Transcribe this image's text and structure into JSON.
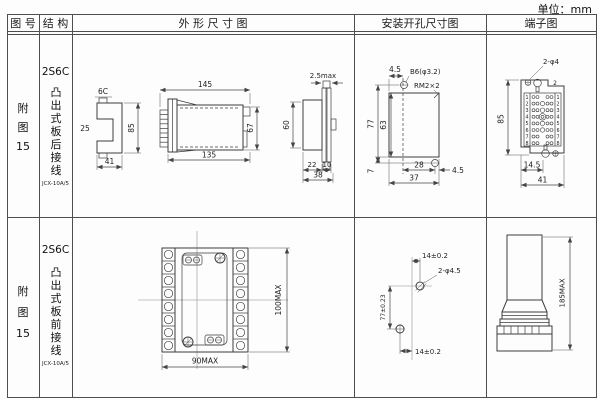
{
  "unit_label": "单位：mm",
  "header": {
    "fig": "图 号",
    "struct": "结 构",
    "outline": "外 形 尺 寸 图",
    "mount": "安装开孔尺寸图",
    "terminal": "端子图"
  },
  "row1": {
    "fig_l1": "附",
    "fig_l2": "图",
    "fig_l3": "15",
    "model": "2S6C",
    "desc": "凸出式板后接线",
    "type": "JCX-10A/5",
    "outline": {
      "lbl_6c": "6C",
      "d25": "25",
      "d85": "85",
      "d41": "41",
      "d145": "145",
      "d135": "135",
      "d67": "67",
      "d25max": "2.5max",
      "d60": "60",
      "d22": "22",
      "d10": "10",
      "d38": "38"
    },
    "mount": {
      "d45_top": "4.5",
      "hole": "B6(φ3.2)",
      "thread": "RM2×2",
      "d77": "77",
      "d63": "63",
      "d7": "7",
      "d28": "28",
      "d37": "37",
      "d45_right": "4.5"
    },
    "terminal": {
      "hole": "2-φ4",
      "n2": "2",
      "d85": "85",
      "d145": "14.5",
      "d41": "41",
      "left": [
        "1",
        "2",
        "3",
        "4",
        "5",
        "6",
        "7",
        "8"
      ],
      "right": [
        "1",
        "2",
        "3",
        "4",
        "5",
        "6",
        "7",
        "8"
      ]
    }
  },
  "row2": {
    "fig_l1": "附",
    "fig_l2": "图",
    "fig_l3": "15",
    "model": "2S6C",
    "desc": "凸出式板前接线",
    "type": "JCX-10A/5",
    "outline": {
      "d90": "90MAX",
      "d100": "100MAX"
    },
    "mount": {
      "d14_top": "14±0.2",
      "hole": "2-φ4.5",
      "d77": "77±0.23",
      "d14_bottom": "14±0.2"
    },
    "terminal": {
      "d185": "185MAX"
    }
  }
}
